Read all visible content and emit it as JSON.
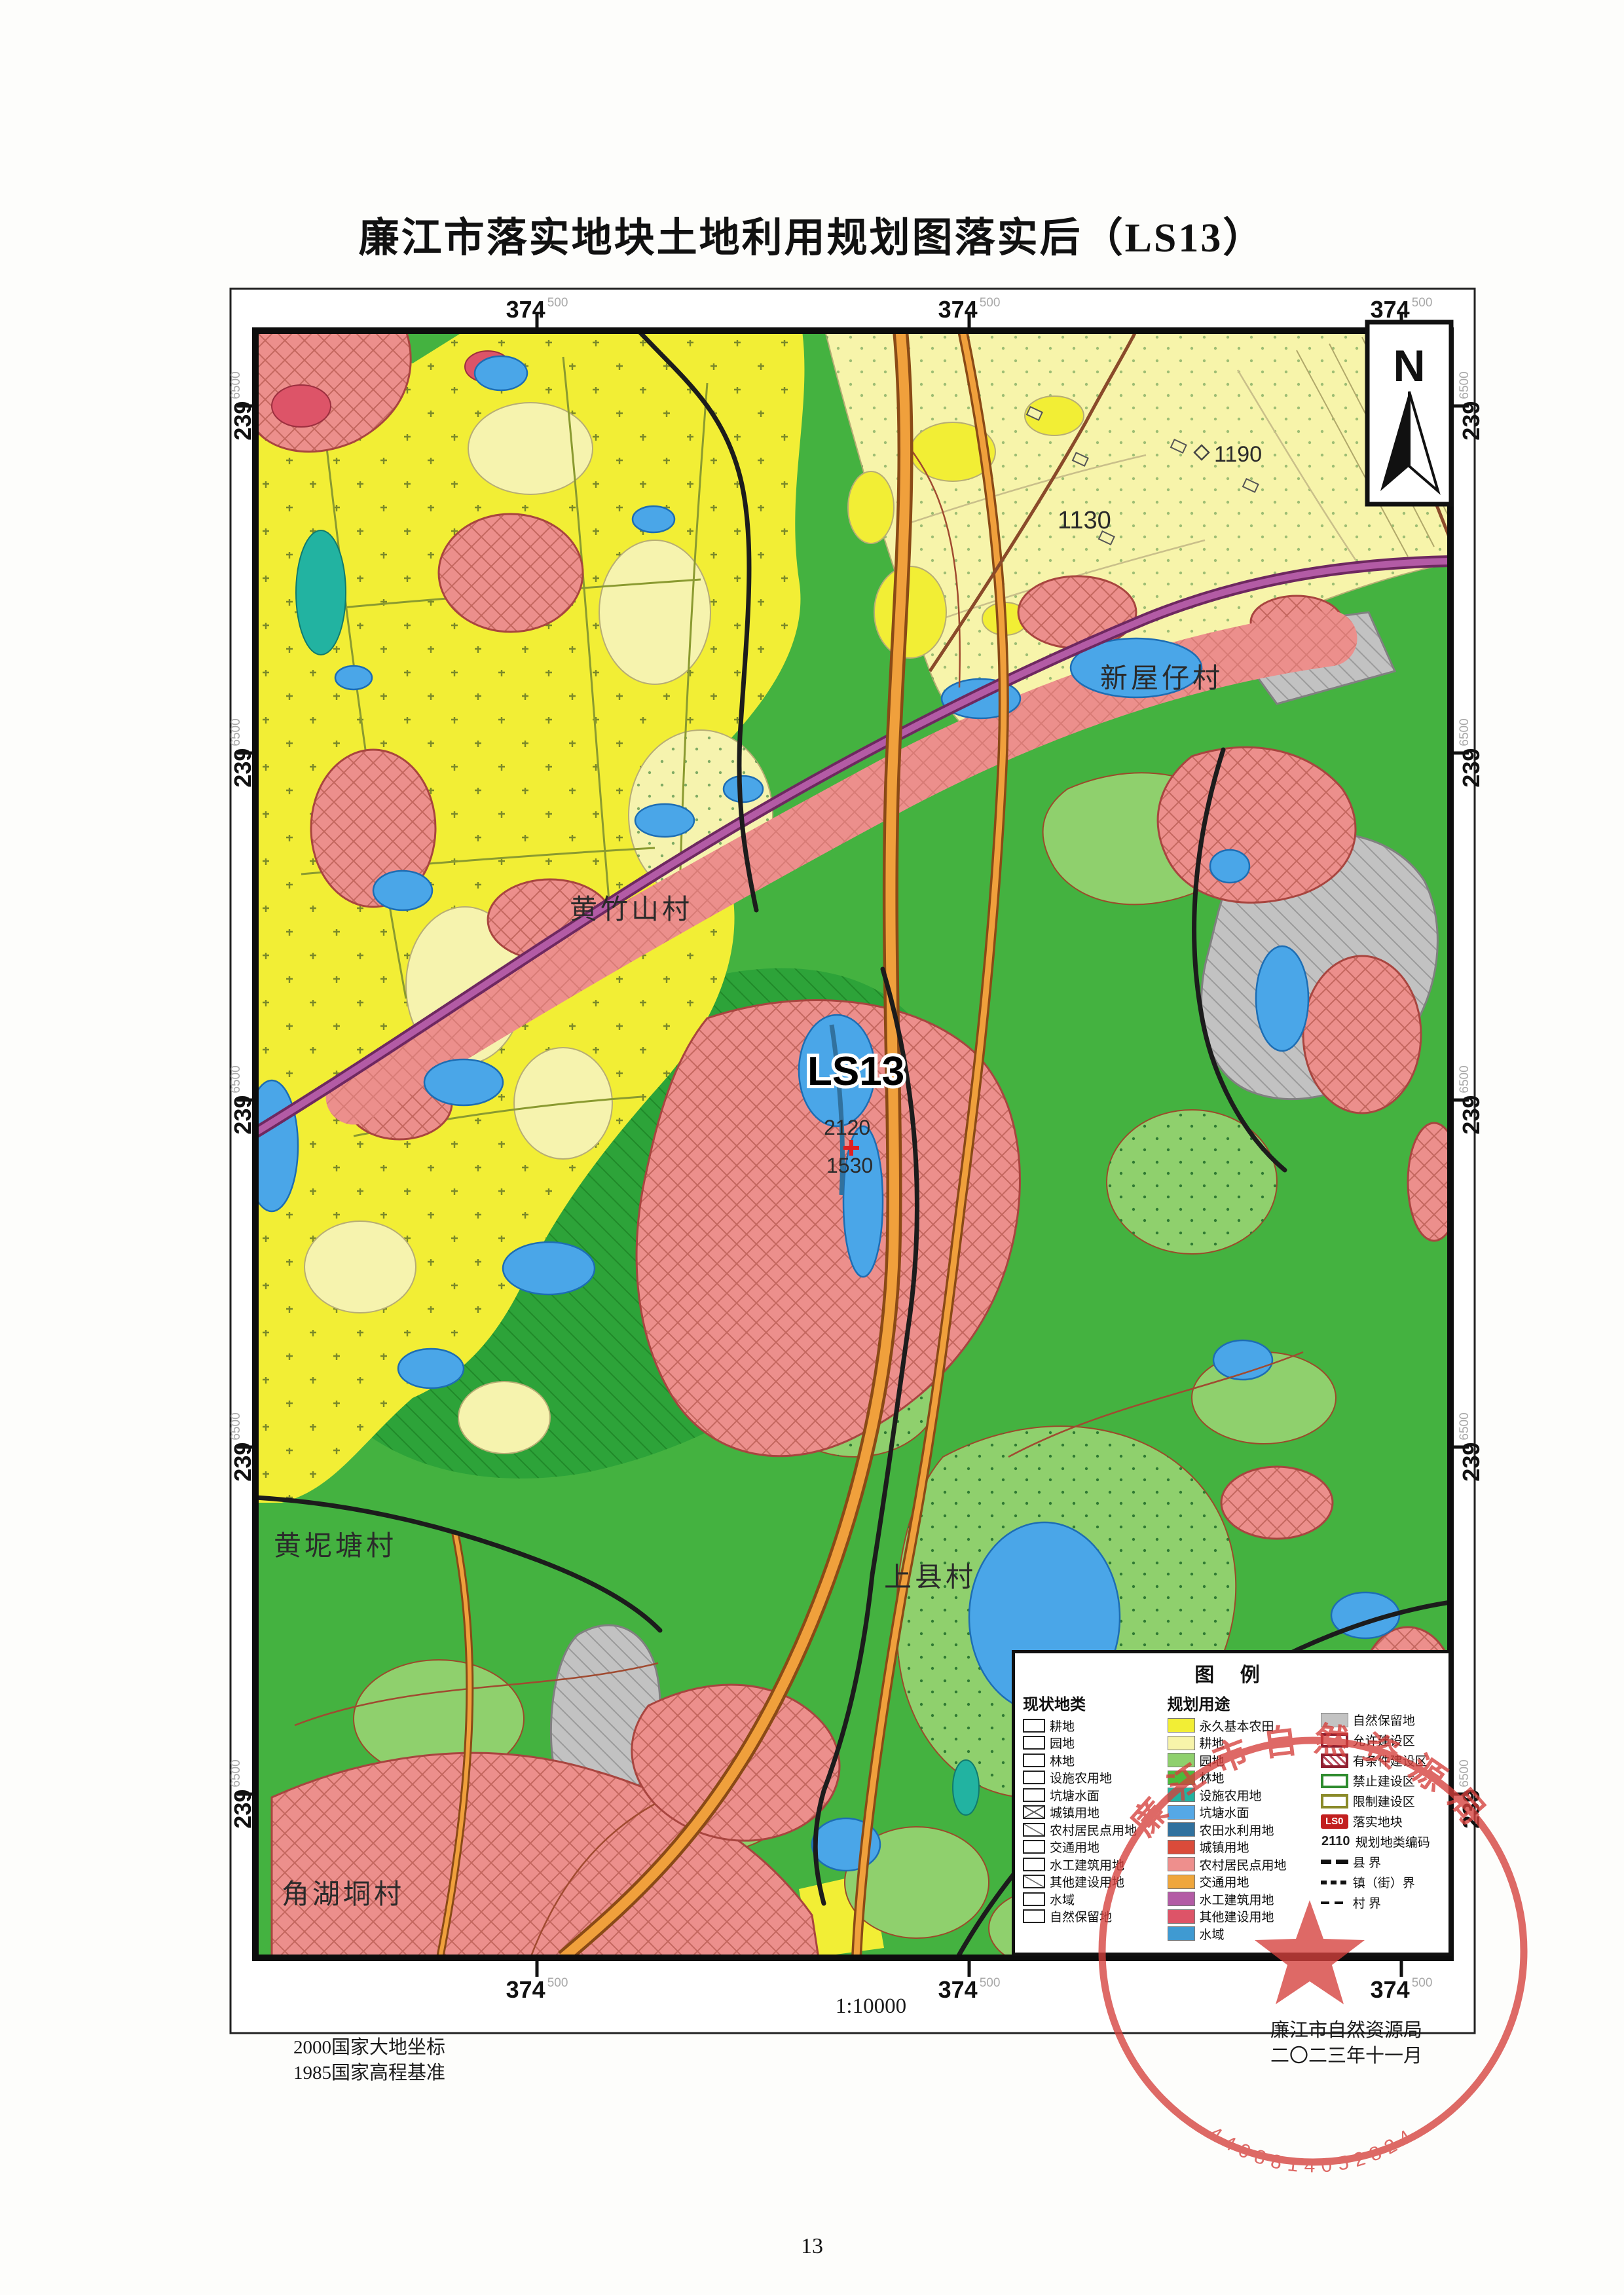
{
  "page": {
    "title": "廉江市落实地块土地利用规划图落实后（LS13）",
    "page_number": "13"
  },
  "frame": {
    "easting": "374",
    "easting_sup": "500",
    "northing": "239",
    "northing_sup": "6500"
  },
  "north_arrow": {
    "label": "N"
  },
  "map_labels": {
    "plot_code": "LS13",
    "plan_code_upper": "2120",
    "plan_code_lower": "1530",
    "code_1130": "1130",
    "code_1190": "1190",
    "village_xinwuzai": "新屋仔村",
    "village_huangzhushan": "黄竹山村",
    "village_huangnitang": "黄坭塘村",
    "village_shangxian": "上县村",
    "village_jiaohudong": "角湖垌村"
  },
  "legend": {
    "title": "图 例",
    "current": {
      "header": "现状地类",
      "items": [
        {
          "label": "耕地",
          "icon": "box"
        },
        {
          "label": "园地",
          "icon": "box"
        },
        {
          "label": "林地",
          "icon": "box"
        },
        {
          "label": "设施农用地",
          "icon": "box"
        },
        {
          "label": "坑塘水面",
          "icon": "box"
        },
        {
          "label": "城镇用地",
          "icon": "box-x"
        },
        {
          "label": "农村居民点用地",
          "icon": "box-diag"
        },
        {
          "label": "交通用地",
          "icon": "box"
        },
        {
          "label": "水工建筑用地",
          "icon": "box"
        },
        {
          "label": "其他建设用地",
          "icon": "box-diag"
        },
        {
          "label": "水域",
          "icon": "box"
        },
        {
          "label": "自然保留地",
          "icon": "box"
        }
      ]
    },
    "planned": {
      "header": "规划用途",
      "items": [
        {
          "label": "永久基本农田",
          "color": "#f2ee35"
        },
        {
          "label": "耕地",
          "color": "#f7f4aa"
        },
        {
          "label": "园地",
          "color": "#8fd06d"
        },
        {
          "label": "林地",
          "color": "#4cbb3c"
        },
        {
          "label": "设施农用地",
          "color": "#22b3a1"
        },
        {
          "label": "坑塘水面",
          "color": "#55a8e6"
        },
        {
          "label": "农田水利用地",
          "color": "#31719e"
        },
        {
          "label": "城镇用地",
          "color": "#da4b3a"
        },
        {
          "label": "农村居民点用地",
          "color": "#ee8f8d"
        },
        {
          "label": "交通用地",
          "color": "#efa63c"
        },
        {
          "label": "水工建筑用地",
          "color": "#b35ba5"
        },
        {
          "label": "其他建设用地",
          "color": "#dd5468"
        },
        {
          "label": "水域",
          "color": "#3f9ad2"
        }
      ]
    },
    "zones": {
      "items": [
        {
          "label": "自然保留地",
          "icon": "swatch-gray"
        },
        {
          "label": "允许建设区",
          "icon": "rect-darkred"
        },
        {
          "label": "有条件建设区",
          "icon": "rect-darkred-hatch"
        },
        {
          "label": "禁止建设区",
          "icon": "rect-green"
        },
        {
          "label": "限制建设区",
          "icon": "rect-olive"
        },
        {
          "label": "落实地块",
          "icon": "tag-red",
          "tag": "LS0"
        },
        {
          "label": "规划地类编码",
          "icon": "code",
          "code": "2110"
        },
        {
          "label": "县 界",
          "icon": "line-county"
        },
        {
          "label": "镇（街）界",
          "icon": "line-town"
        },
        {
          "label": "村 界",
          "icon": "line-village"
        }
      ]
    }
  },
  "footer": {
    "datum1": "2000国家大地坐标",
    "datum2": "1985国家高程基准",
    "scale": "1:10000",
    "agency": "廉江市自然资源局",
    "date": "二〇二三年十一月"
  },
  "stamp": {
    "arc_text": "廉江市自然资源局",
    "serial": "4408814052824"
  },
  "colors": {
    "base_green": "#44b240",
    "bright_yellow": "#f2ee35",
    "pale_yellow": "#f7f4aa",
    "pink_settlement": "#ec8f8c",
    "orange_road": "#f0a03c",
    "purple_road": "#b35ba5",
    "water_blue": "#4aa6e8",
    "stamp_red": "#d5403c"
  }
}
